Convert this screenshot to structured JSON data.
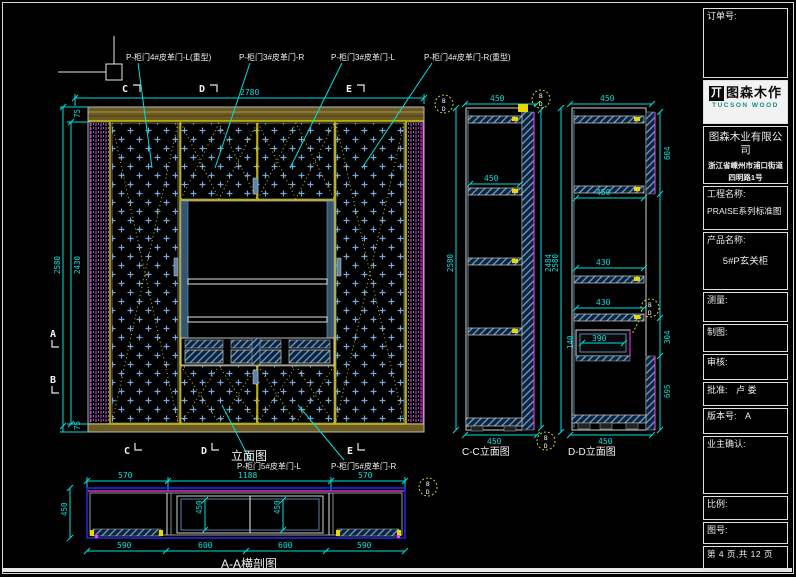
{
  "title_block": {
    "order_label": "订单号:",
    "logo": {
      "name": "图森木作",
      "sub": "TUCSON WOOD",
      "icon": "丌"
    },
    "company": "图森木业有限公司",
    "address1": "浙江省嵊州市浦口街道",
    "address2": "四明路1号",
    "project_label": "工程名称:",
    "project_value": "PRAISE系列标准图",
    "product_label": "产品名称:",
    "product_value": "5#P玄关柜",
    "measure_label": "测量:",
    "draft_label": "制图:",
    "audit_label": "审核:",
    "approve_label": "批准:",
    "approve_value": "卢  娄",
    "version_label": "版本号:",
    "version_value": "A",
    "owner_label": "业主确认:",
    "scale_label": "比例:",
    "figno_label": "图号:",
    "page_info": "第 4 页,共 12 页"
  },
  "elevation": {
    "title": "立面图",
    "label_door1": "P-柜门4#皮革门-L(重型)",
    "label_door2": "P-柜门3#皮革门-R",
    "label_door3": "P-柜门3#皮革门-L",
    "label_door4": "P-柜门4#皮革门-R(重型)",
    "label_door5": "P-柜门5#皮革门-L",
    "label_door6": "P-柜门5#皮革门-R",
    "dim_width": "2780",
    "dim_height": "2580",
    "dim_height_inner": "2430",
    "dim_top": "75",
    "dim_bottom": "75",
    "sec_c": "C",
    "sec_d": "D",
    "sec_e": "E",
    "sec_a": "A",
    "sec_b": "B"
  },
  "section_aa": {
    "title": "A-A横剖图",
    "dim_top": [
      "570",
      "1188",
      "570"
    ],
    "dim_bottom": [
      "590",
      "600",
      "600",
      "590"
    ],
    "dim_left": "450",
    "dim_inner_l": "450",
    "dim_inner_r": "450"
  },
  "section_cc": {
    "title": "C-C立面图",
    "dim_top": "450",
    "dim_shelf": "450",
    "dim_bottom": "450",
    "dim_left": "2580",
    "dim_right": "2484"
  },
  "section_dd": {
    "title": "D-D立面图",
    "dim_top": "450",
    "dim_w1": "450",
    "dim_w2": "430",
    "dim_w3": "430",
    "dim_drawer": "390",
    "dim_drawer_h": "140",
    "dim_r1": "604",
    "dim_r2": "304",
    "dim_r3": "695",
    "dim_left": "2580",
    "dim_bottom": "450"
  },
  "callout": {
    "top": "B",
    "bottom": "D"
  }
}
